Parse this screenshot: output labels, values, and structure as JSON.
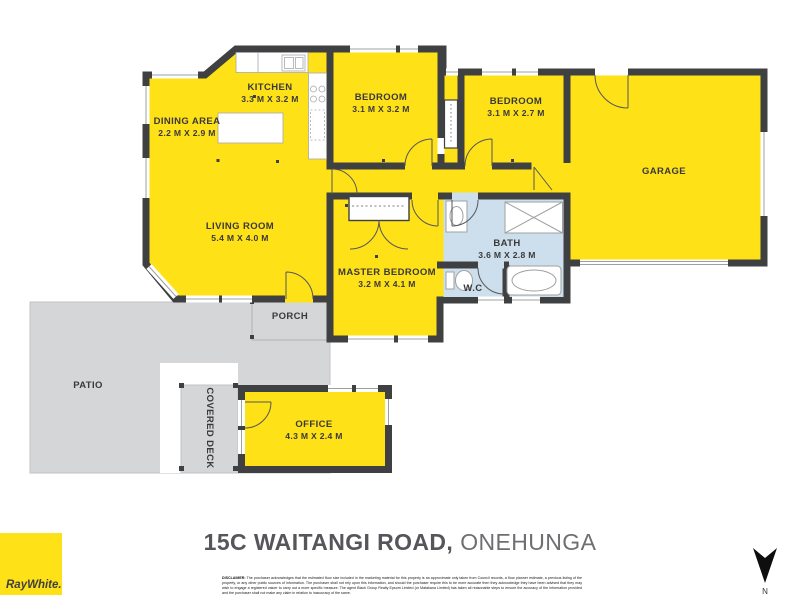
{
  "plan": {
    "rooms": [
      {
        "name": "KITCHEN",
        "dims": "3.3 M X 3.2 M"
      },
      {
        "name": "DINING AREA",
        "dims": "2.2 M X 2.9 M"
      },
      {
        "name": "LIVING ROOM",
        "dims": "5.4 M X 4.0 M"
      },
      {
        "name": "BEDROOM",
        "dims": "3.1 M X 3.2 M"
      },
      {
        "name": "BEDROOM",
        "dims": "3.1 M X 2.7 M"
      },
      {
        "name": "GARAGE",
        "dims": ""
      },
      {
        "name": "BATH",
        "dims": "3.6 M X 2.8 M"
      },
      {
        "name": "W.C",
        "dims": ""
      },
      {
        "name": "MASTER BEDROOM",
        "dims": "3.2 M X 4.1 M"
      },
      {
        "name": "PORCH",
        "dims": ""
      },
      {
        "name": "PATIO",
        "dims": ""
      },
      {
        "name": "COVERED DECK",
        "dims": ""
      },
      {
        "name": "OFFICE",
        "dims": "4.3 M X 2.4 M"
      }
    ],
    "compass_label": "N"
  },
  "footer": {
    "address_bold": "15C WAITANGI ROAD,",
    "address_regular": "ONEHUNGA",
    "brand": "RayWhite.",
    "disclaimer_label": "DISCLAIMER:",
    "disclaimer_text": "The purchaser acknowledges that the estimated floor size included in the marketing material for this property is an approximate only taken from Council records, a floor planner estimate, a previous listing of the property, or any other public sources of information.  The purchaser shall not rely upon this information, and should the purchaser require this to be more accurate then they acknowledge they have been advised that they may wish to engage a registered valuer to carry out a more specific measure.  The agent Black Group Realty Epsom Limited (or Matakana Limited) has taken all reasonable steps to ensure the accuracy of the information provided and the purchaser shall not make any claim in relation to inaccuracy of the same."
  },
  "colors": {
    "plan_yellow": "#FFE117",
    "wall_dark": "#3F4042",
    "bath_blue": "#CDDFEC",
    "outdoor_grey": "#D5D6D8",
    "title_grey": "#55565A",
    "brand_yellow": "#FFE117"
  }
}
